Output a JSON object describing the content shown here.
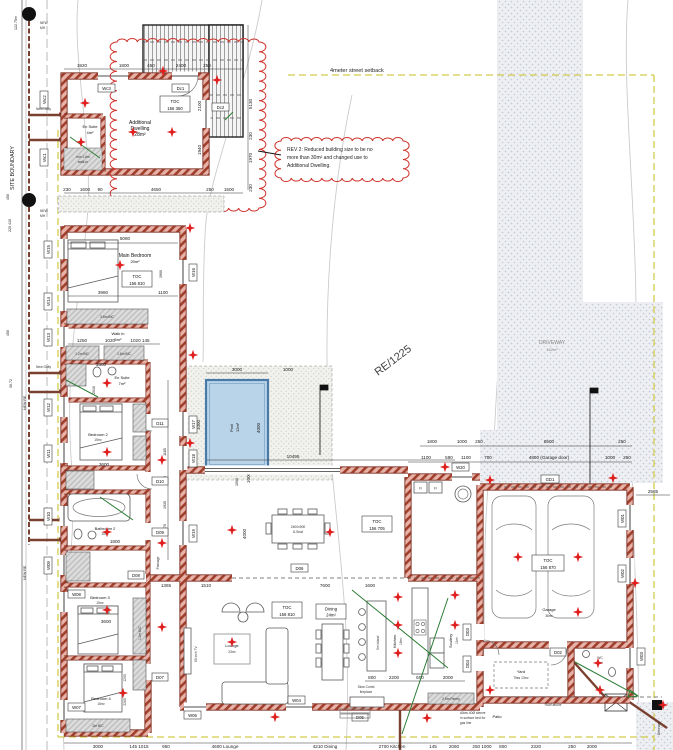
{
  "colors": {
    "wall": "#a13f2d",
    "cloud": "#cf342c",
    "pool": "#b9d3e8",
    "star": "#e01f1f",
    "setback_yellow": "#d3cb4c",
    "sewer_brown": "#7a4030",
    "plumb_green": "#2c7d35"
  },
  "boundary": {
    "site_boundary": "SITE BOUNDARY",
    "len_122": "122.75m",
    "n220": "220 410",
    "n450a": "450",
    "n450b": "450",
    "n3072": "30.72",
    "new_re_a": "NEW RE",
    "new_re_b": "NEW RE",
    "mh_l1": "NEW",
    "mh_l2": "MH"
  },
  "setback": {
    "street": "4meter street setback"
  },
  "rev": {
    "l1": "REV 2: Reduced building size to be no",
    "l2": "more than 30m² and changed use to",
    "l3": "Additional Dwelling."
  },
  "site": {
    "driveway1": "DRIVEWAY",
    "driveway2": "162m²",
    "erf": "RE/1225",
    "s2585": "2585",
    "roof": "Roof above",
    "gas1": "Allow 40Ø sleeve",
    "gas2": "in surface bed for",
    "gas3": "gas line",
    "gully": "New Gully",
    "patio": "Patio",
    "drive_side": "Driveway"
  },
  "dwelling": {
    "l1": "Additional",
    "l2": "Dwelling",
    "l3": "28m²",
    "toc1": "TOC",
    "toc2": "156 350",
    "es1": "En Suite",
    "es2": "4m²",
    "walkin1": "min 1.6m",
    "walkin2": "walk-in"
  },
  "pool": {
    "l1": "Pool",
    "l2": "12m²"
  },
  "rooms": {
    "main1": "Main Bedroom",
    "main2": "20m²",
    "toc_main1": "TOC",
    "toc_main2": "156 810",
    "bic36": "3.6m BIC",
    "walkin1": "Walk in",
    "walkin2": "5m²",
    "bic12": "1.2m BIC",
    "bic18": "1.8m BIC",
    "es1": "En Suite",
    "es2": "7m²",
    "bed2a": "Bedroom 2",
    "bed2b": "15m²",
    "bath2a": "Bathroom 2",
    "bath2b": "10m²",
    "passage": "Passage",
    "bed3a": "Bedroom 3",
    "bed3b": "15m²",
    "bic12b": "1.2m BIC",
    "bed4a": "Bedroom 4",
    "bed4b": "15m²",
    "bic2m": "2m BIC",
    "toc_liv1": "TOC",
    "toc_liv2": "156 705",
    "toc_lng1": "TOC",
    "toc_lng2": "156 810",
    "lounge1": "Lounge",
    "lounge2": "23m²",
    "din1": "Dining",
    "din2": "24m²",
    "tbl1": "2400x900",
    "tbl2": "8-Seat",
    "fire1": "Slow Comb",
    "fire2": "fireplace",
    "tv": "65 inch TV",
    "kit1": "Kitchen",
    "kit2": "16m²",
    "island": "5m Island",
    "pantry": "2.5m Pantry",
    "scu1": "Scullery",
    "scu2": "11m²",
    "fr": "Fr",
    "gar1": "Garage",
    "gar2": "36m²",
    "toc_gar1": "TOC",
    "toc_gar2": "156 870",
    "wc1": "WC",
    "wc2": "2m²",
    "yard1": "Yard",
    "yard2": "Tiles 13m²"
  },
  "tags": {
    "wc1": "Wc1",
    "wc2": "Wc2",
    "wc3": "Wc3",
    "dc1": "Dc1",
    "dc2": "Dc2",
    "gd1": "GD1",
    "w01": "W01",
    "w02": "W02",
    "w03": "W03",
    "w04": "W04",
    "w06": "W06",
    "w07": "W07",
    "w08": "W08",
    "w09": "W09",
    "w10": "W10",
    "w11": "W11",
    "w12": "W12",
    "w13": "W13",
    "w14": "W14",
    "w15": "W15",
    "w16": "W16",
    "w17": "W17",
    "w18": "W18",
    "w19": "W19",
    "w20": "W20",
    "d02": "D02",
    "d03": "D03",
    "d04": "D04",
    "d05": "D05",
    "d06": "D06",
    "d07": "D07",
    "d08": "D08",
    "d09": "D09",
    "d10": "D10",
    "d11": "D11"
  },
  "dims": {
    "top": [
      "1920",
      "1800",
      "450",
      "2400",
      "250"
    ],
    "dw_right": [
      "5130",
      "230",
      "1970",
      "230",
      "2100",
      "1940"
    ],
    "dw_bottom": [
      "230",
      "1600",
      "90",
      "4650",
      "250",
      "1500",
      "900"
    ],
    "wing": [
      "5080",
      "3980",
      "1100",
      "1250",
      "1020",
      "1020 145",
      "3300",
      "2010",
      "3600",
      "1800",
      "3600",
      "1200",
      "2285",
      "3900"
    ],
    "east": [
      "1185",
      "1000",
      "1935",
      "1970"
    ],
    "pool": [
      "3000",
      "1000",
      "1000",
      "4000",
      "1000",
      "10495"
    ],
    "great": [
      "1365",
      "1510",
      "7600",
      "1600",
      "4000",
      "1000"
    ],
    "gar1": [
      "1800",
      "1000",
      "250",
      "8500",
      "250"
    ],
    "gar2": [
      "1100",
      "590",
      "1100",
      "700",
      "4800 (Garage door)",
      "1000",
      "250"
    ],
    "kitchen": [
      "800",
      "2200",
      "600",
      "2000"
    ],
    "bottom": [
      "3000",
      "145 1015",
      "950",
      "4600 Lounge",
      "4210 Dining",
      "2700 Kitchen",
      "145",
      "2060",
      "250 1000",
      "800",
      "2320",
      "250",
      "2000"
    ]
  }
}
